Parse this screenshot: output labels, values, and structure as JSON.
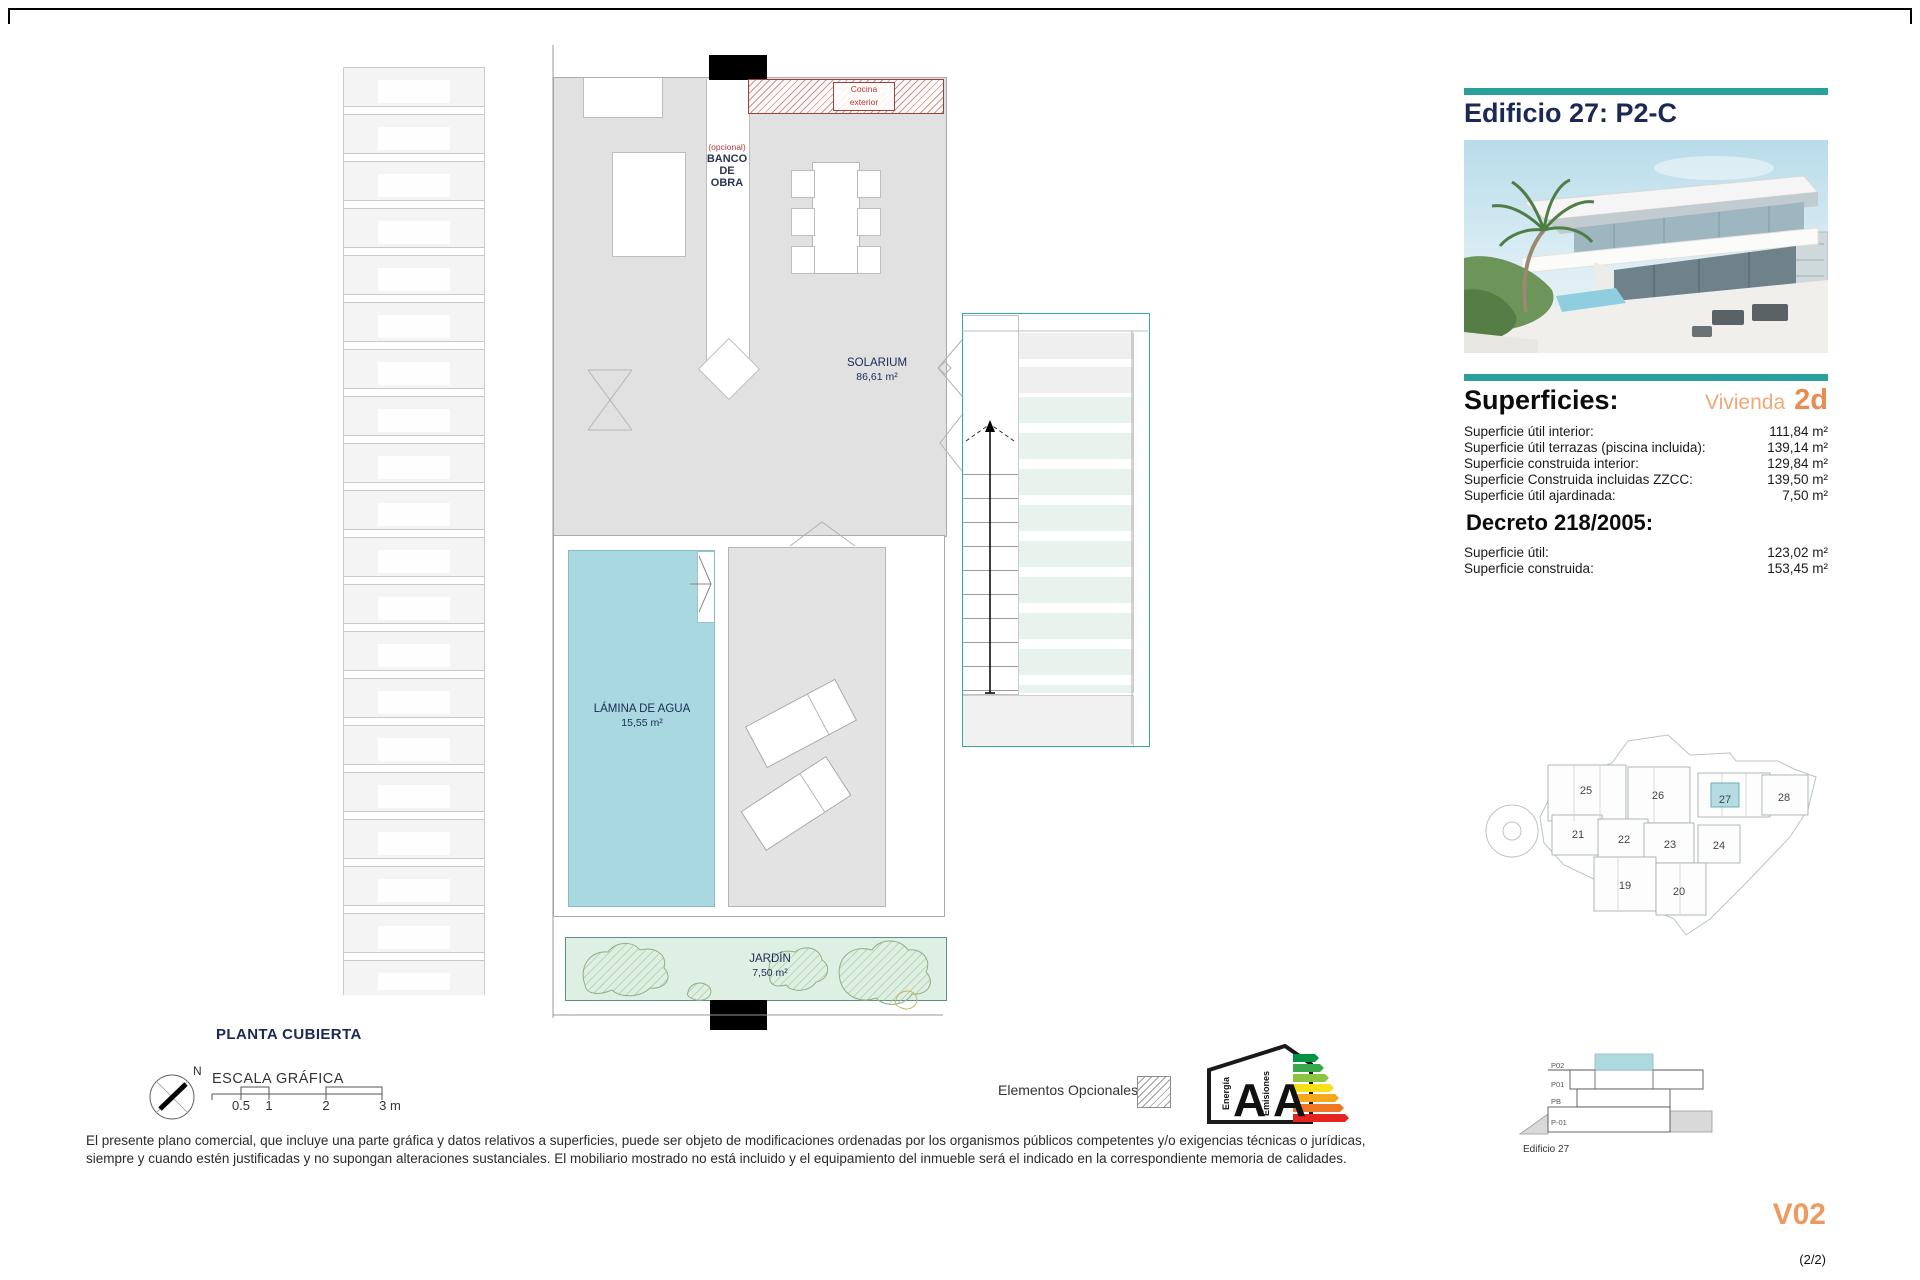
{
  "panel": {
    "title": "Edificio 27: P2-C",
    "superficies": {
      "heading": "Superficies:",
      "vivienda_label": "Vivienda",
      "vivienda_value": "2d",
      "rows": [
        {
          "label": "Superficie útil interior:",
          "value": "111,84 m²"
        },
        {
          "label": "Superficie útil terrazas (piscina incluida):",
          "value": "139,14 m²"
        },
        {
          "label": "Superficie construida interior:",
          "value": "129,84 m²"
        },
        {
          "label": "Superficie Construida incluidas ZZCC:",
          "value": "139,50 m²"
        },
        {
          "label": "Superficie útil ajardinada:",
          "value": "7,50 m²"
        }
      ]
    },
    "decreto": {
      "heading": "Decreto 218/2005:",
      "rows": [
        {
          "label": "Superficie útil:",
          "value": "123,02 m²"
        },
        {
          "label": "Superficie construida:",
          "value": "153,45 m²"
        }
      ]
    },
    "version": "V02",
    "page_indicator": "(2/2)"
  },
  "plan": {
    "title": "PLANTA CUBIERTA",
    "compass_north": "N",
    "scale": {
      "heading": "ESCALA GRÁFICA",
      "ticks": [
        "0.5",
        "1",
        "2",
        "3 m"
      ]
    },
    "labels": {
      "solarium": {
        "name": "SOLARIUM",
        "area": "86,61 m²"
      },
      "lamina": {
        "name": "LÁMINA DE AGUA",
        "area": "15,55 m²"
      },
      "jardin": {
        "name": "JARDÍN",
        "area": "7,50 m²"
      },
      "banco": {
        "optional": "(opcional)",
        "l1": "BANCO",
        "l2": "DE",
        "l3": "OBRA"
      },
      "cocina": {
        "l1": "Cocina",
        "l2": "exterior"
      }
    }
  },
  "legend": {
    "elementos_opcionales": "Elementos Opcionales",
    "energy": {
      "left_label": "Energía",
      "left_value": "A",
      "right_label": "Emisiones",
      "right_value": "A"
    }
  },
  "site_plan": {
    "buildings": [
      "25",
      "26",
      "27",
      "28",
      "21",
      "22",
      "23",
      "24",
      "19",
      "20"
    ],
    "highlighted_building": "27",
    "highlight_color": "#b4dce2"
  },
  "section": {
    "floors": [
      "P02",
      "P01",
      "PB",
      "P-01"
    ],
    "caption": "Edificio 27",
    "highlight_color": "#aed9de"
  },
  "disclaimer": {
    "line1": "El presente plano comercial, que incluye una parte gráfica y datos relativos a superficies, puede ser objeto de modificaciones ordenadas por los organismos públicos competentes y/o exigencias técnicas o jurídicas,",
    "line2": "siempre y cuando estén justificadas y no supongan alteraciones sustanciales. El mobiliario mostrado no está incluido y el equipamiento del inmueble será el indicado en la correspondiente memoria de calidades."
  },
  "colors": {
    "teal": "#2b9e9e",
    "navy": "#1c2957",
    "orange": "#ec9a5f",
    "pool": "#a9d8e0",
    "garden": "#def0e3"
  }
}
